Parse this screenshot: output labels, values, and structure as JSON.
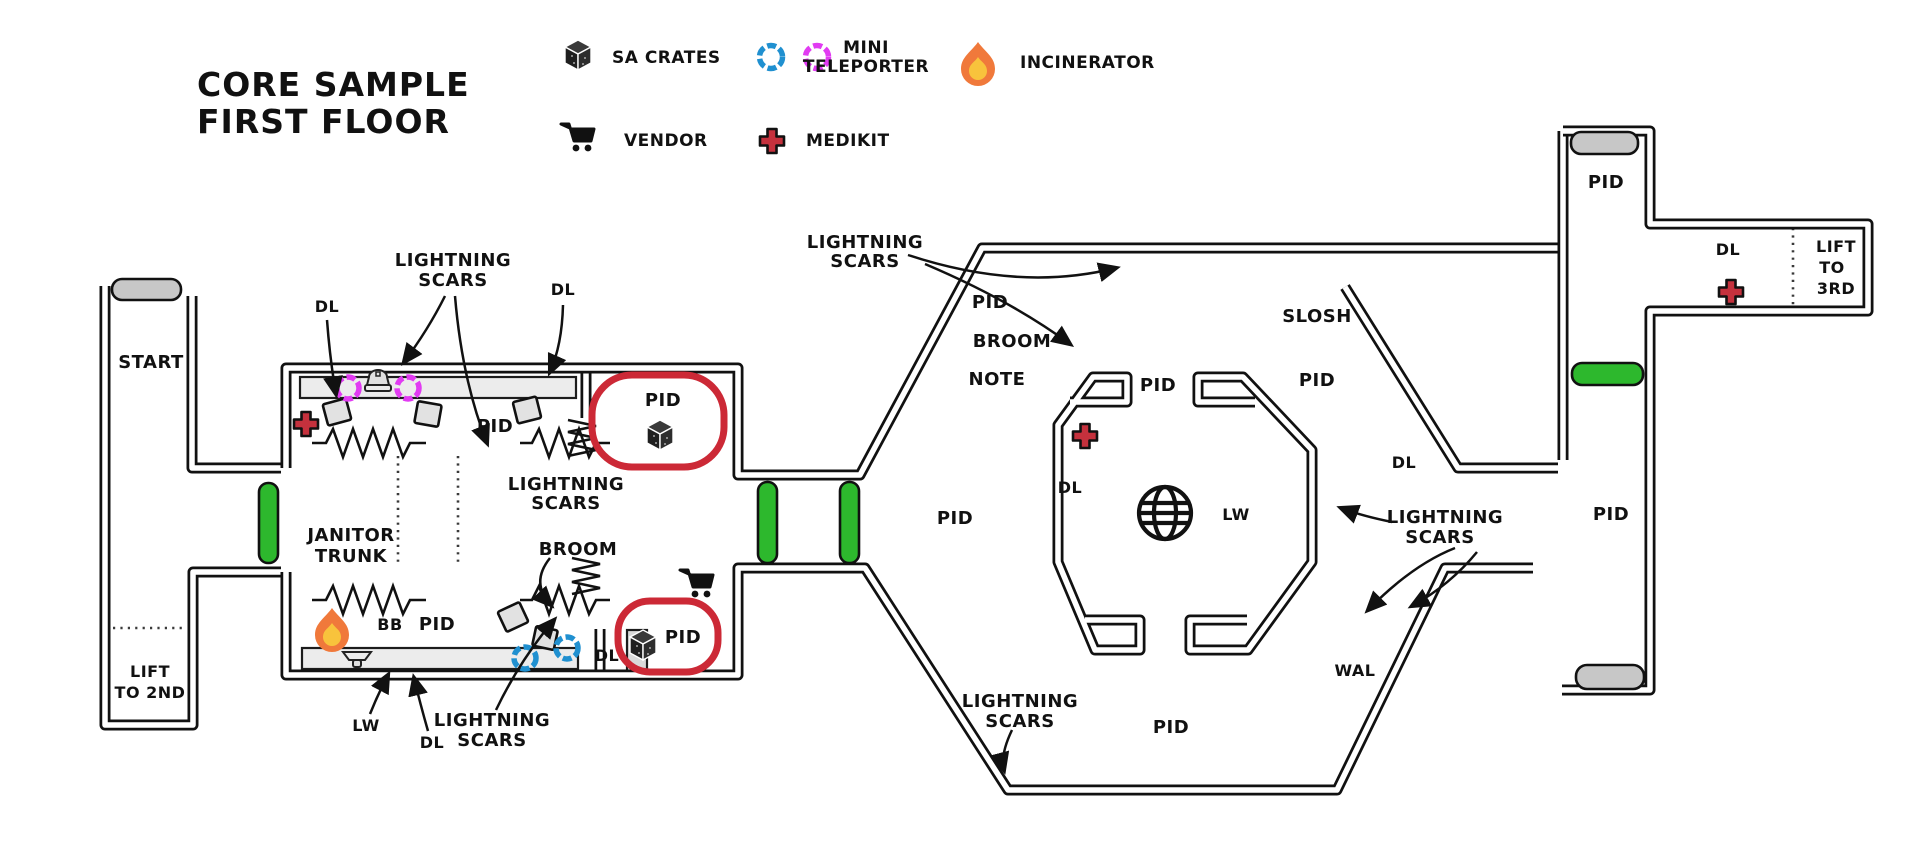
{
  "title": {
    "line1": "CORE SAMPLE",
    "line2": "FIRST FLOOR"
  },
  "legend": {
    "sa_crates": "SA CRATES",
    "mini_teleporter_line1": "MINI",
    "mini_teleporter_line2": "TELEPORTER",
    "incinerator": "INCINERATOR",
    "vendor": "VENDOR",
    "medikit": "MEDIKIT"
  },
  "labels": {
    "start": "START",
    "lift_2nd_line1": "LIFT",
    "lift_2nd_line2": "TO 2ND",
    "lift_3rd_line1": "LIFT",
    "lift_3rd_line2": "TO",
    "lift_3rd_line3": "3RD",
    "dl": "DL",
    "pid": "PID",
    "lightning_line1": "LIGHTNING",
    "lightning_line2": "SCARS",
    "janitor_line1": "JANITOR",
    "janitor_line2": "TRUNK",
    "broom": "BROOM",
    "note": "NOTE",
    "bb": "BB",
    "lw": "LW",
    "slosh": "SLOSH",
    "wal": "WAL"
  },
  "colors": {
    "wall": "#111111",
    "door_green": "#2db82d",
    "bar_gray": "#c7c7c7",
    "enclosure_red": "#cc2936",
    "medikit_red": "#c5313d",
    "teleporter_blue": "#2090d0",
    "teleporter_magenta": "#e13bf2",
    "flame_orange": "#f0793b",
    "flame_yellow": "#f8c33c",
    "platform_gray": "#ececec"
  }
}
